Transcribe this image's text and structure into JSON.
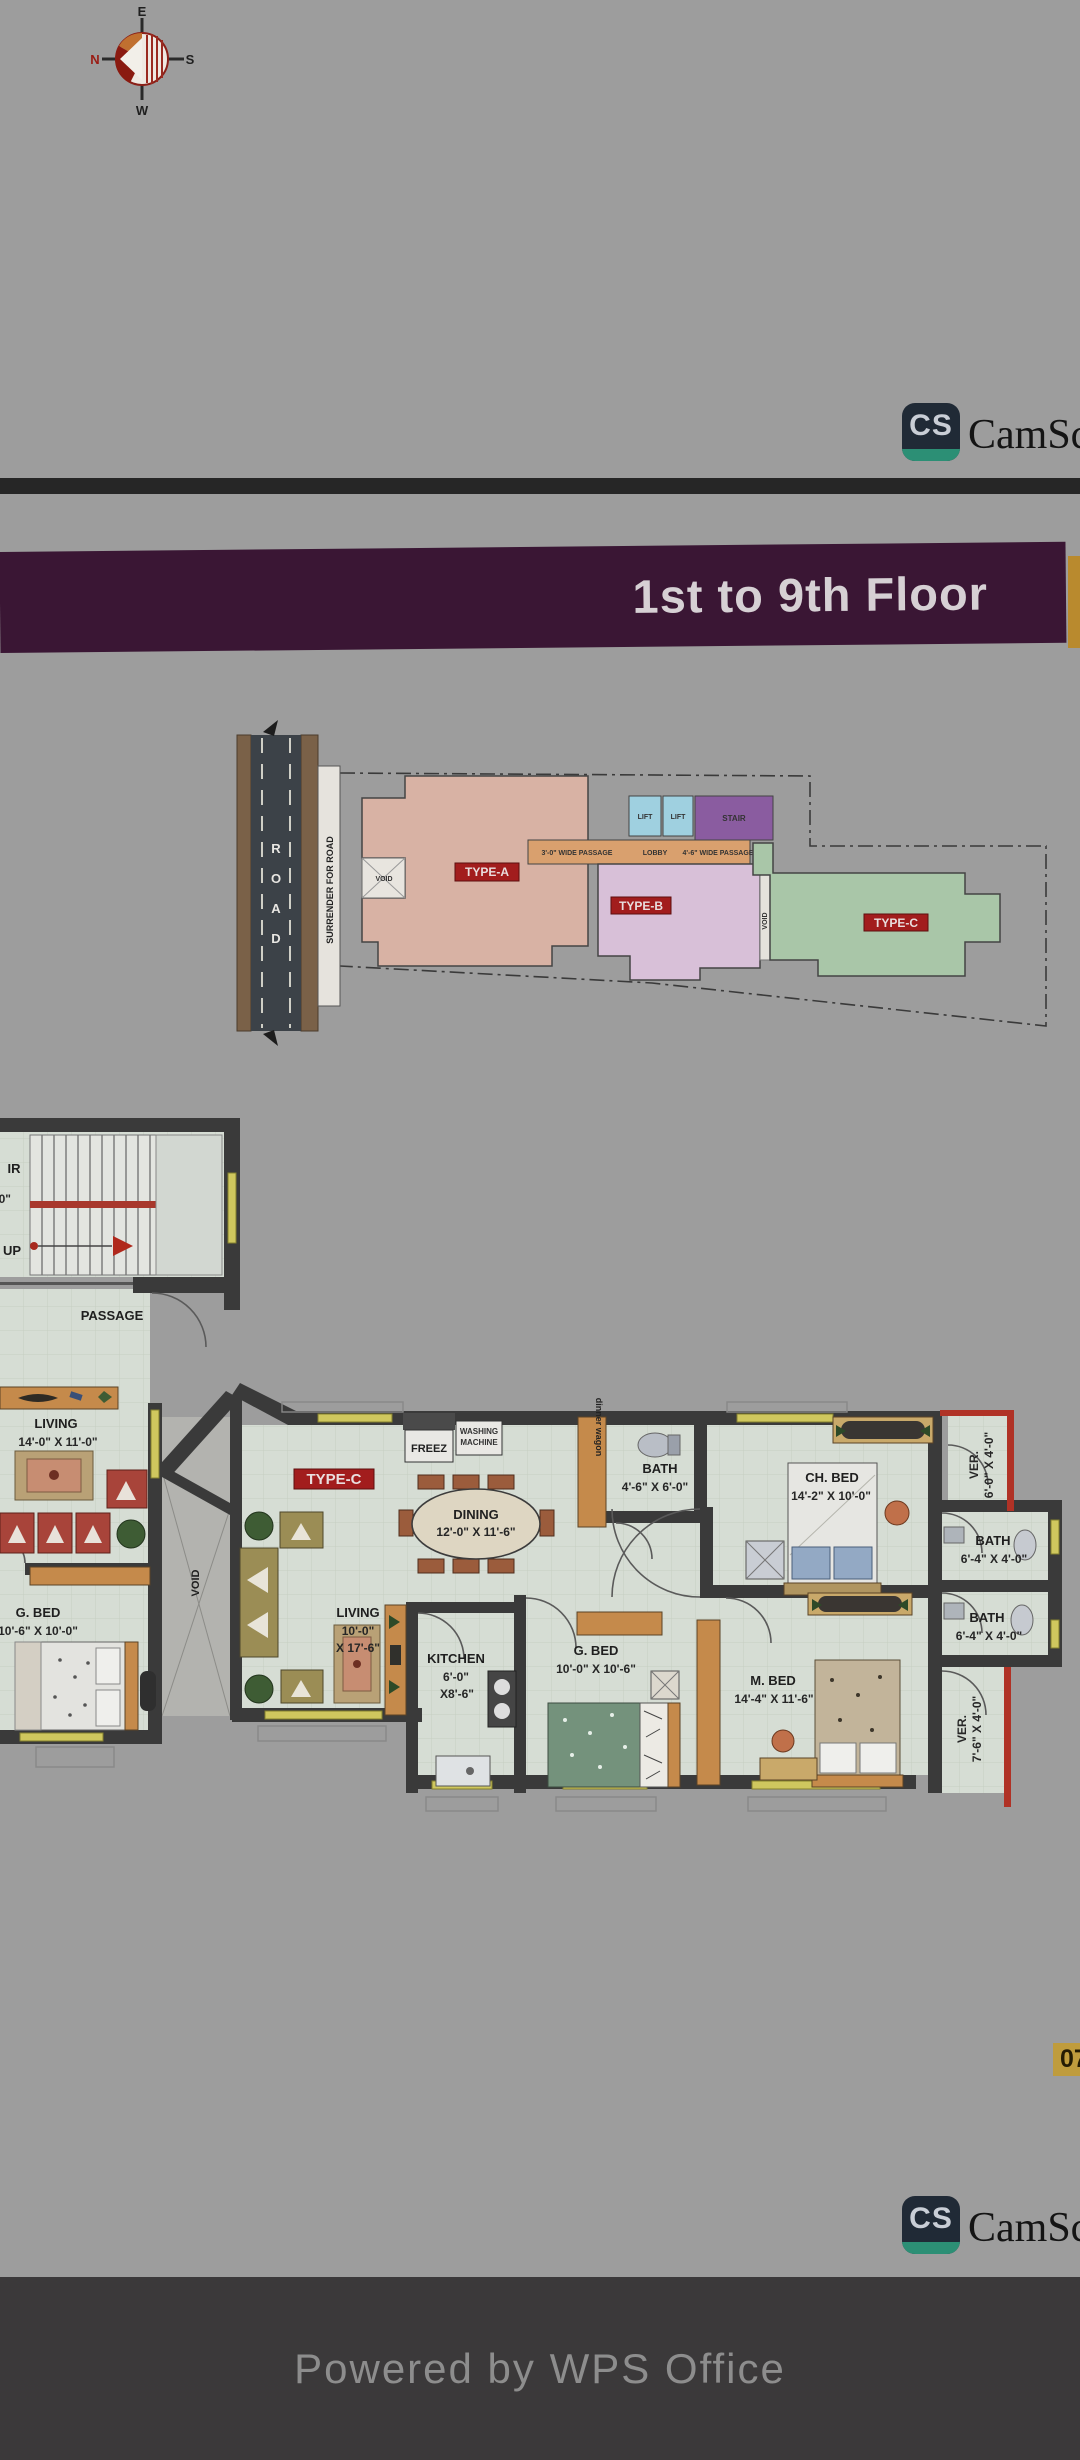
{
  "viewer": {
    "powered_by": "Powered by WPS Office"
  },
  "scanner": {
    "logo": "CS",
    "brand": "CamScanner"
  },
  "page_badge": "07",
  "compass": {
    "n": "N",
    "e": "E",
    "s": "S",
    "w": "W"
  },
  "banner": {
    "title": "1st to 9th Floor"
  },
  "site": {
    "road_letters": [
      "R",
      "O",
      "A",
      "D"
    ],
    "surrender": "SURRENDER FOR ROAD",
    "passage_left": "3'-0\" WIDE PASSAGE",
    "lobby": "LOBBY",
    "passage_right": "4'-6\" WIDE PASSAGE",
    "lift1": "LIFT",
    "lift2": "LIFT",
    "stair": "STAIR",
    "type_a": "TYPE-A",
    "type_b": "TYPE-B",
    "type_c": "TYPE-C",
    "void_a": "VOID",
    "void_b": "VOID"
  },
  "fp": {
    "stair_cut": "IR",
    "stair_dim": "8'-0\"",
    "up": "UP",
    "passage": "PASSAGE",
    "living1": {
      "name": "LIVING",
      "dim": "14'-0\" X 11'-0\""
    },
    "gbed1": {
      "name": "G. BED",
      "dim": "10'-6\" X 10'-0\""
    },
    "void": "VOID",
    "badge": "TYPE-C",
    "freez": "FREEZ",
    "washing1": "WASHING",
    "washing2": "MACHINE",
    "dining": {
      "name": "DINING",
      "dim": "12'-0\" X 11'-6\""
    },
    "wagon": "dinner wagon",
    "bath1": {
      "name": "BATH",
      "dim": "4'-6\" X 6'-0\""
    },
    "chbed": {
      "name": "CH. BED",
      "dim": "14'-2\" X 10'-0\""
    },
    "ver1": {
      "name": "VER.",
      "dim": "6'-0\" X 4'-0\""
    },
    "bath2": {
      "name": "BATH",
      "dim": "6'-4\" X 4'-0\""
    },
    "bath3": {
      "name": "BATH",
      "dim": "6'-4\" X 4'-0\""
    },
    "ver2": {
      "name": "VER.",
      "dim": "7'-6\" X 4'-0\""
    },
    "living2": {
      "name": "LIVING",
      "dim1": "10'-0\"",
      "dim2": "X 17'-6\""
    },
    "kitchen": {
      "name": "KITCHEN",
      "dim1": "6'-0\"",
      "dim2": "X8'-6\""
    },
    "gbed2": {
      "name": "G. BED",
      "dim": "10'-0\" X 10'-6\""
    },
    "mbed": {
      "name": "M. BED",
      "dim": "14'-4\" X 11'-6\""
    }
  }
}
